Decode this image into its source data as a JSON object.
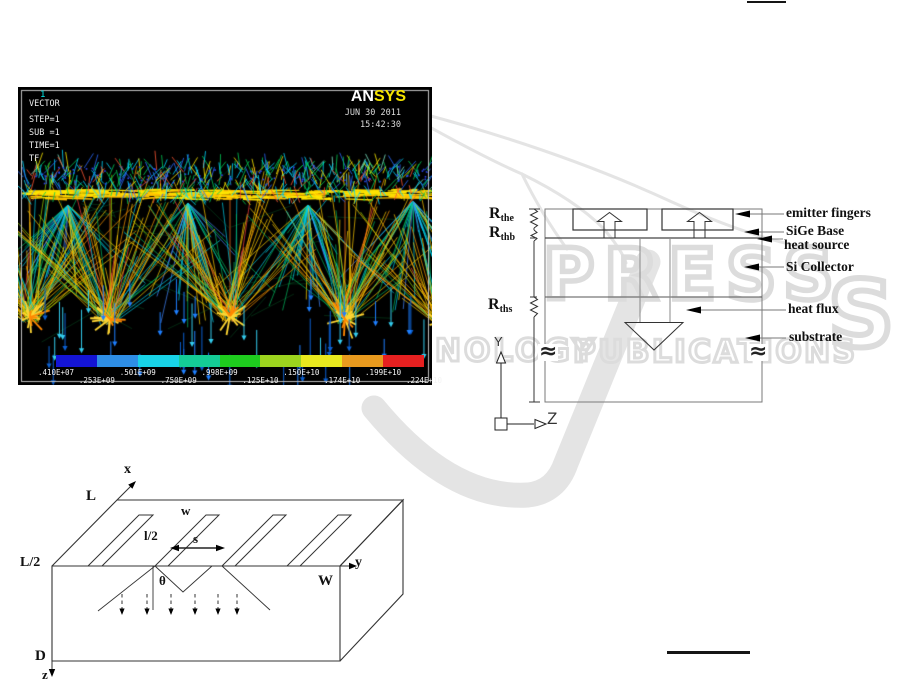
{
  "figure_plot": {
    "window_id": "1",
    "annotations": [
      "VECTOR",
      "STEP=1",
      "SUB =1",
      "TIME=1",
      "TF"
    ],
    "logo_an": "AN",
    "logo_sys": "SYS",
    "date": "JUN 30 2011",
    "time": "15:42:30",
    "colorbar": {
      "colors": [
        "#1414d4",
        "#2e8ee6",
        "#18d2e6",
        "#14cc96",
        "#1ecc1e",
        "#9cd41e",
        "#e8e81e",
        "#e89a1e",
        "#e62020"
      ],
      "labels_top": [
        ".410E+07",
        ".501E+09",
        ".998E+09",
        ".150E+10",
        ".199E+10"
      ],
      "labels_bottom": [
        ".253E+09",
        ".750E+09",
        ".125E+10",
        ".174E+10",
        ".224E+10"
      ]
    }
  },
  "schematic": {
    "resistors": [
      {
        "base": "R",
        "sub": "the"
      },
      {
        "base": "R",
        "sub": "thb"
      },
      {
        "base": "R",
        "sub": "ths"
      }
    ],
    "labels": [
      "emitter fingers",
      "SiGe Base",
      "heat source",
      "Si Collector",
      "heat flux",
      "substrate"
    ],
    "break_left": "≈",
    "break_right": "≈",
    "axis_y": "Y",
    "axis_z": "Z"
  },
  "figure3d": {
    "labels": {
      "x": "x",
      "cap_l": "L",
      "l_half": "L/2",
      "w": "w",
      "finger_half": "l/2",
      "s": "s",
      "theta": "θ",
      "y": "y",
      "cap_w": "W",
      "cap_d": "D",
      "z": "z"
    }
  },
  "watermark": {
    "word_main": "PRESS",
    "word_s": "S",
    "word_left2": "NOLOGY",
    "word_right2": "PUBLICATIONS",
    "color": "#dcdcdc"
  }
}
